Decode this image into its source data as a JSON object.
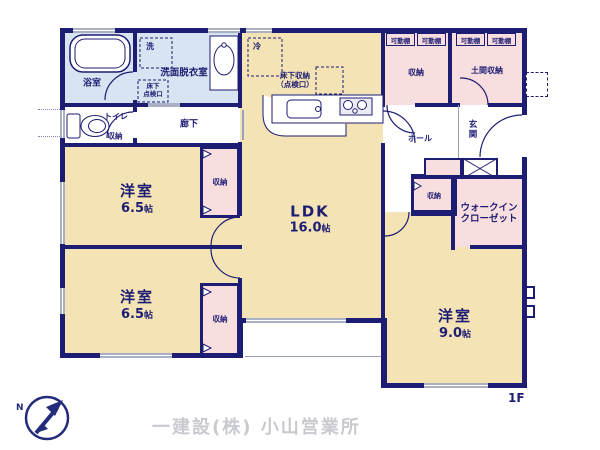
{
  "colors": {
    "wall": "#1d1d73",
    "room_cream": "#f4e3b5",
    "room_pink": "#f8dede",
    "room_blue": "#d9e4f3",
    "window_gray": "#a9b0c4",
    "label_navy": "#1d1d73",
    "footer_gray": "#c8cad0"
  },
  "plan": {
    "floor_label": "1F",
    "rooms": {
      "bath": {
        "label": "浴室"
      },
      "washroom": {
        "label": "洗面脱衣室",
        "washer": "洗",
        "underfloor_l1": "床下",
        "underfloor_l2": "点検口"
      },
      "toilet": {
        "label": "トイレ",
        "storage": "収納"
      },
      "hallway": {
        "label": "廊下"
      },
      "ldk": {
        "name": "LDK",
        "size_value": "16.0",
        "size_unit": "帖",
        "fridge": "冷",
        "underfloor_l1": "床下収納",
        "underfloor_l2": "（点検口）"
      },
      "bedroom1": {
        "name": "洋室",
        "size_value": "6.5",
        "size_unit": "帖",
        "closet": "収納"
      },
      "bedroom2": {
        "name": "洋室",
        "size_value": "6.5",
        "size_unit": "帖",
        "closet": "収納"
      },
      "bedroom3": {
        "name": "洋室",
        "size_value": "9.0",
        "size_unit": "帖"
      },
      "wic": {
        "label_l1": "ウォークイン",
        "label_l2": "クローゼット"
      },
      "hall": {
        "label": "ホール",
        "storage": "収納"
      },
      "genkan": {
        "label_c1": "玄",
        "label_c2": "関"
      },
      "storage_top": {
        "label": "収納"
      },
      "doma": {
        "label": "土間収納"
      },
      "shelves": {
        "s1": "可動棚",
        "s2": "可動棚",
        "s3": "可動棚",
        "s4": "可動棚"
      }
    }
  },
  "footer": {
    "company": "一建設(株) 小山営業所"
  },
  "compass": {
    "letter": "N"
  }
}
